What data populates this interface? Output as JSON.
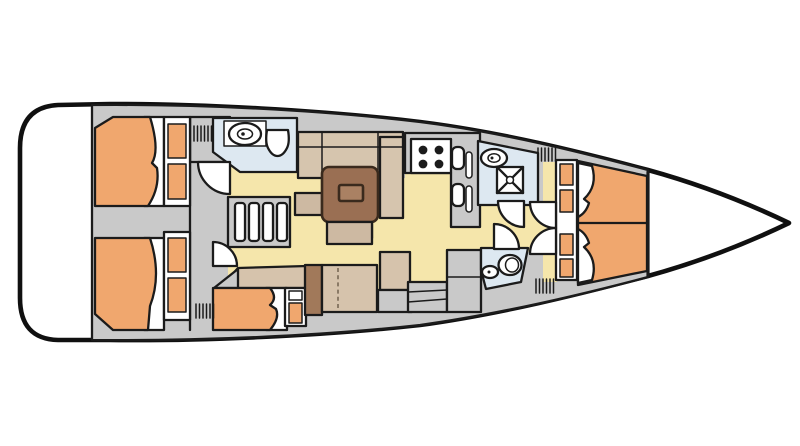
{
  "diagram": {
    "type": "yacht-interior-layout-plan",
    "view": "top-down",
    "orientation": "bow-right-stern-left",
    "areas": [
      "transom-platform",
      "aft-cabin-port",
      "aft-cabin-starboard",
      "mid-berth-starboard",
      "aft-head-port",
      "companionway-stairs",
      "salon-dinette",
      "galley",
      "forward-head-starboard",
      "day-head-starboard",
      "forward-v-berth-cabin",
      "bow-locker"
    ],
    "fixtures": [
      "double-berth",
      "pillow",
      "wardrobe",
      "washbasin-sink",
      "toilet",
      "shower-pan",
      "stove-4-burner",
      "galley-sinks",
      "salon-table",
      "settee",
      "bench-seat",
      "deck-hatch",
      "cabin-door",
      "mast-step",
      "shelf-lockers"
    ],
    "hatch_count": 5,
    "door_count": 6
  },
  "colors": {
    "none": "none",
    "white": "#ffffff",
    "line": "#1b1b1b",
    "deck": "#c9c9c9",
    "floor": "#f5e6ab",
    "berth": "#f0a76e",
    "headroom": "#dde8f1",
    "settee": "#d6c5ae",
    "cushion": "#cdb9a2",
    "table": "#9a6f53",
    "tableInner": "#aa8163",
    "wood": "#a1795a",
    "bench": "#d6c3ac"
  }
}
